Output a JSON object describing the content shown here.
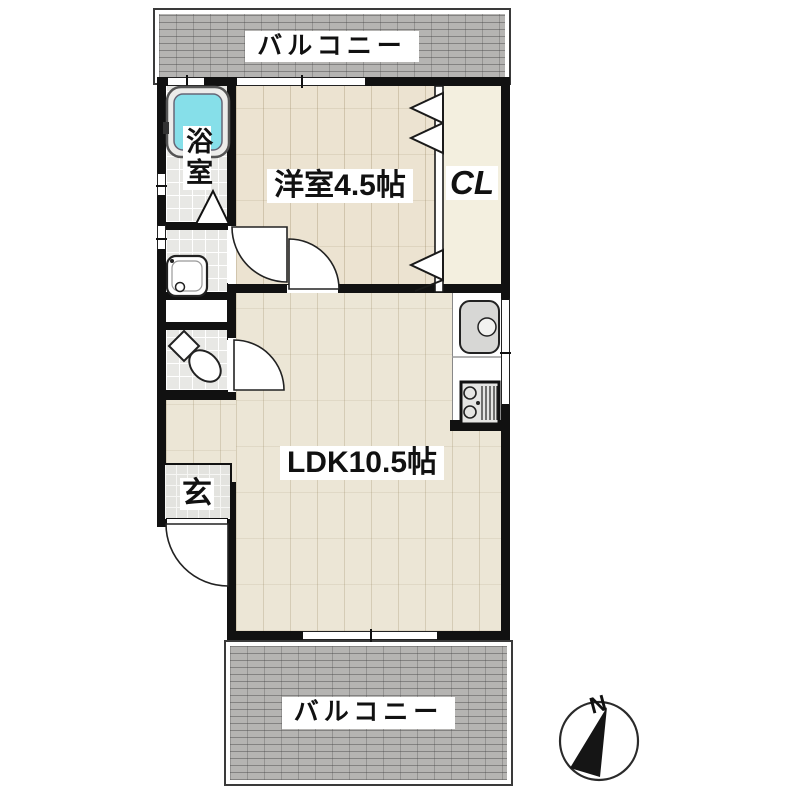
{
  "balconies": {
    "top": {
      "label": "バルコニー"
    },
    "bottom": {
      "label": "バルコニー"
    }
  },
  "rooms": {
    "western": {
      "label": "洋室4.5帖"
    },
    "closet": {
      "label": "CL"
    },
    "ldk": {
      "label": "LDK10.5帖"
    },
    "bath": {
      "label": "浴室"
    },
    "entrance": {
      "label": "玄"
    }
  },
  "compass": {
    "north_label": "N"
  },
  "colors": {
    "wall": "#111111",
    "wood": "#ece3d1",
    "wood_ldk": "#ece6d6",
    "closet": "#f3efdf",
    "tile": "#e8e8e5",
    "balcony": "#b5b4b2",
    "tub": "#86dfe9"
  }
}
